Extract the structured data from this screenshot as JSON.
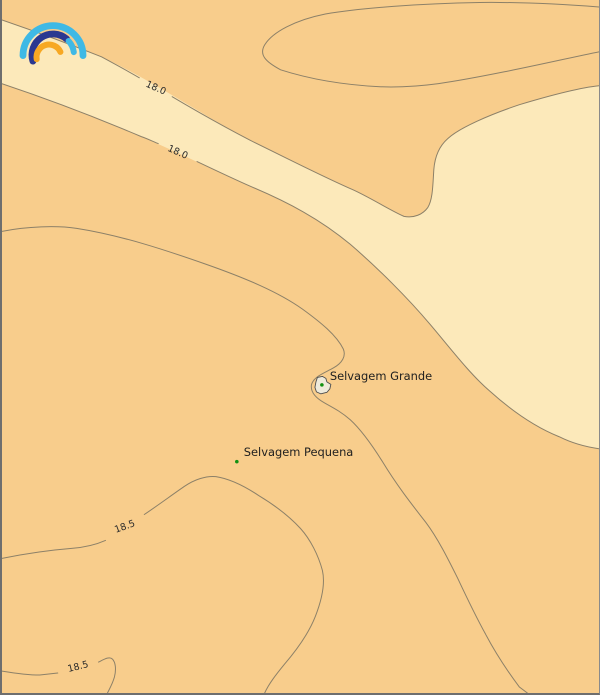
{
  "map": {
    "type": "temperature-contour-map",
    "isotherms_c": [
      18.0,
      18.5
    ],
    "contour_labels": [
      {
        "text": "18.0"
      },
      {
        "text": "18.0"
      },
      {
        "text": "18.5"
      },
      {
        "text": "18.5"
      }
    ],
    "places": [
      {
        "name": "Selvagem Grande"
      },
      {
        "name": "Selvagem Pequena"
      }
    ],
    "colors": {
      "sea_warm": "#F8CD8C",
      "sea_cool": "#FCE9BA",
      "contour_line": "#8C8068",
      "place_marker": "#129112",
      "island_fill": "#EEEADA",
      "label_text": "#1F1F1F",
      "border": "#6E6E6E"
    }
  },
  "logo": {
    "name": "meteoblue rainbow logo",
    "colors": {
      "outer_arc": "#3FB9E5",
      "middle_arc": "#2B3890",
      "middle_right_arc": "#3FB9E5",
      "inner_arc": "#F7A823"
    }
  }
}
